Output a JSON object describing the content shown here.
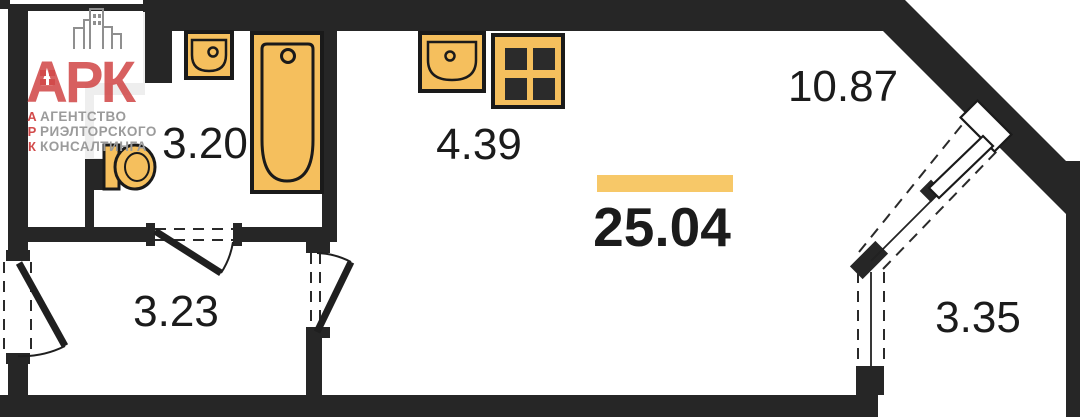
{
  "logo": {
    "brand": "АРК",
    "vertical": [
      "А",
      "Р",
      "К"
    ],
    "lines": [
      "АГЕНТСТВО",
      "РИЭЛТОРСКОГО",
      "КОНСАЛТИНГА"
    ],
    "colors": {
      "red": "#d24b4b",
      "gray": "#9b9b9b",
      "building": "#8f8f8f"
    }
  },
  "floorplan": {
    "total_area": "25.04",
    "rooms": [
      {
        "name": "bathroom",
        "area": "3.20"
      },
      {
        "name": "kitchen",
        "area": "4.39"
      },
      {
        "name": "living-room",
        "area": "10.87"
      },
      {
        "name": "hallway",
        "area": "3.23"
      },
      {
        "name": "balcony",
        "area": "3.35"
      }
    ],
    "colors": {
      "wall": "#262626",
      "fixture_fill": "#f5bf5d",
      "fixture_stroke": "#1a1a1a",
      "highlight_bar": "#f7c868",
      "label_text": "#1b1b1b"
    }
  }
}
